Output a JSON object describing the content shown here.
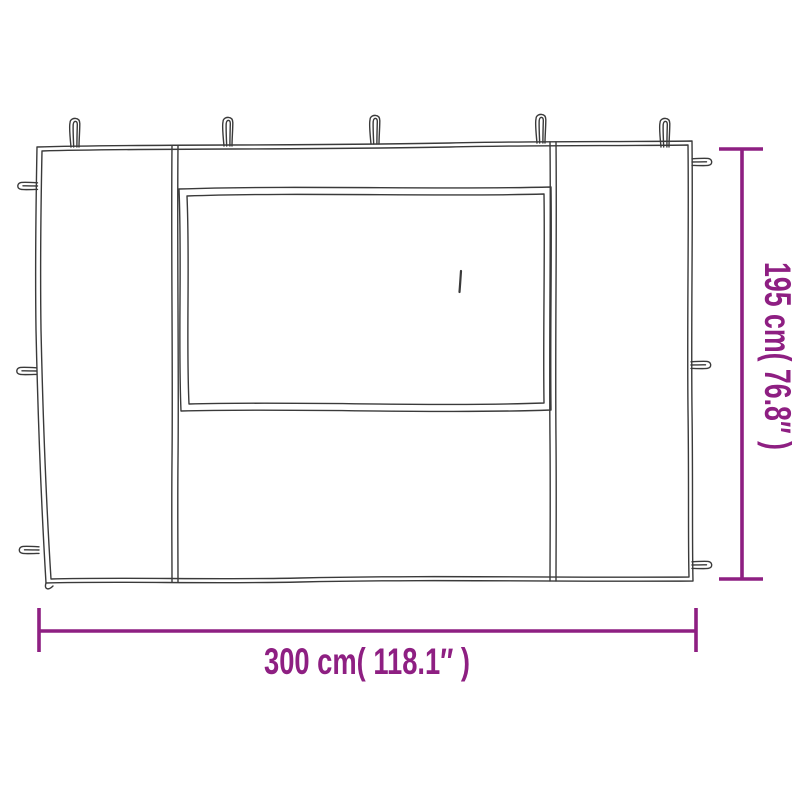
{
  "diagram": {
    "subject": "sidewall-panel-with-window-line-drawing",
    "line_color": "#3a3a3a",
    "accent_color": "#8E1F82",
    "background_color": "#ffffff",
    "width_dimension_label": "300 cm( 118.1″ )",
    "height_dimension_label": "195 cm( 76.8″ )"
  }
}
